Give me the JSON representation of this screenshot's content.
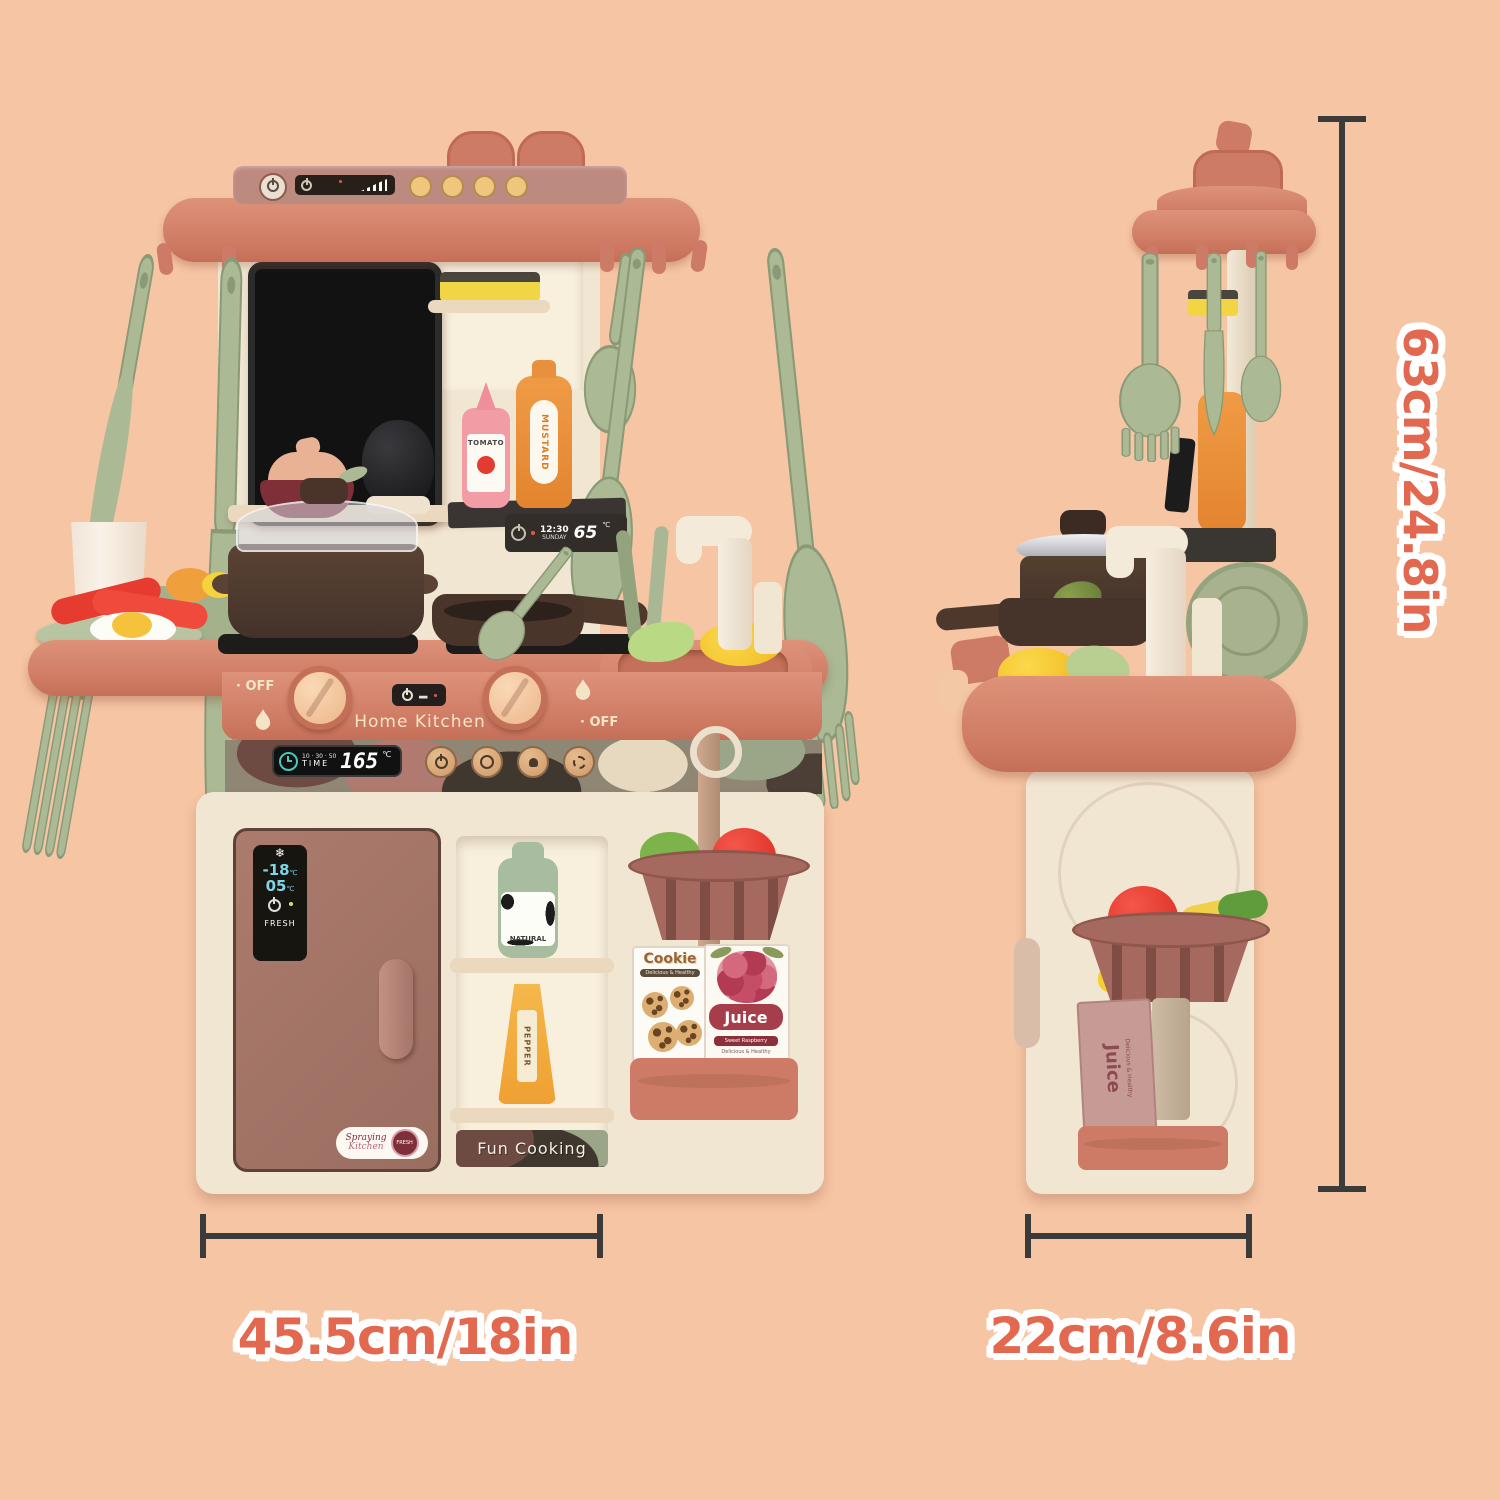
{
  "annotations": {
    "height_label": "63cm/24.8in",
    "front_width_label": "45.5cm/18in",
    "side_width_label": "22cm/8.6in"
  },
  "front_view": {
    "brand": "Home Kitchen",
    "knob_left_off": "· OFF",
    "knob_right_off": "· OFF",
    "timer": {
      "label": "TIME",
      "presets": "10 · 30 · 50",
      "value": "165",
      "unit": "℃"
    },
    "shelf_clock": {
      "time": "12:30",
      "day": "SUNDAY",
      "temp": "65",
      "unit": "℃"
    },
    "fridge": {
      "freezer_temp": "-18",
      "chiller_temp": "05",
      "temp_unit": "℃",
      "fresh": "FRESH",
      "logo_line1": "Spraying",
      "logo_line2": "Kitchen",
      "logo_badge": "FRESH"
    },
    "labels": {
      "ketchup": "TOMATO",
      "mustard": "MUSTARD",
      "milk": "NATURAL",
      "pepper": "PEPPER"
    },
    "cookie_box": {
      "title": "Cookie",
      "subtitle": "Delicious & Healthy"
    },
    "juice_box": {
      "title": "Juice",
      "flavor": "Sweet Raspberry",
      "subtitle": "Delicious & Healthy"
    },
    "footer": "Fun Cooking"
  },
  "side_view": {
    "juice_box": {
      "title": "Juice",
      "subtitle": "Delicious & Healthy"
    }
  }
}
